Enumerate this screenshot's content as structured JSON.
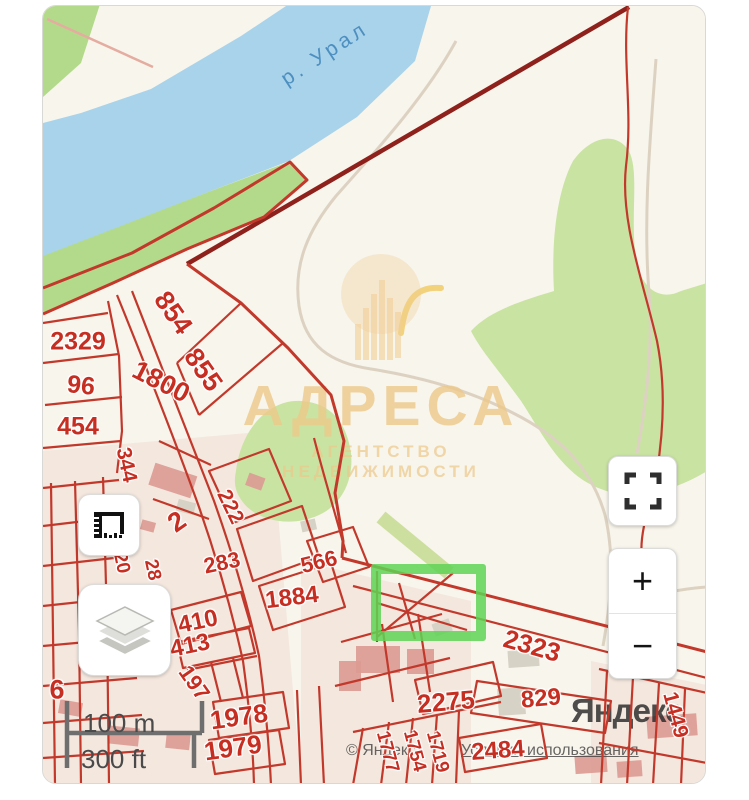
{
  "theme": {
    "land": "#f8f5ec",
    "water": "#a9d3ea",
    "green1": "#b3da8a",
    "green2": "#c9e3a2",
    "red": "#c2392c",
    "darkred": "#8e211b",
    "select": "#5ed355",
    "gold": "#eec888",
    "building": "#dc9a92",
    "graybldg": "#d6d2c6",
    "road": "#ddd2c2"
  },
  "map": {
    "river_label": "р. Урал",
    "parcels": [
      {
        "text": "2329",
        "x": 77,
        "y": 341,
        "rot": 0,
        "size": 25
      },
      {
        "text": "96",
        "x": 80,
        "y": 385,
        "rot": 6,
        "size": 25
      },
      {
        "text": "454",
        "x": 77,
        "y": 426,
        "rot": 0,
        "size": 25
      },
      {
        "text": "854",
        "x": 172,
        "y": 312,
        "rot": 55,
        "size": 27
      },
      {
        "text": "855",
        "x": 202,
        "y": 369,
        "rot": 55,
        "size": 27
      },
      {
        "text": "1800",
        "x": 160,
        "y": 381,
        "rot": 27,
        "size": 27
      },
      {
        "text": "344",
        "x": 125,
        "y": 464,
        "rot": 78,
        "size": 21
      },
      {
        "text": "2",
        "x": 176,
        "y": 521,
        "rot": -35,
        "size": 27
      },
      {
        "text": "222",
        "x": 229,
        "y": 506,
        "rot": 64,
        "size": 21
      },
      {
        "text": "283",
        "x": 221,
        "y": 562,
        "rot": -12,
        "size": 22
      },
      {
        "text": "566",
        "x": 318,
        "y": 561,
        "rot": -14,
        "size": 22
      },
      {
        "text": "1884",
        "x": 291,
        "y": 597,
        "rot": -7,
        "size": 24
      },
      {
        "text": "20",
        "x": 120,
        "y": 562,
        "rot": 78,
        "size": 19
      },
      {
        "text": "28",
        "x": 151,
        "y": 569,
        "rot": 78,
        "size": 19
      },
      {
        "text": "410",
        "x": 197,
        "y": 621,
        "rot": -12,
        "size": 24
      },
      {
        "text": "413",
        "x": 189,
        "y": 645,
        "rot": -12,
        "size": 24
      },
      {
        "text": "197",
        "x": 193,
        "y": 682,
        "rot": 55,
        "size": 22
      },
      {
        "text": "6",
        "x": 56,
        "y": 689,
        "rot": 0,
        "size": 27
      },
      {
        "text": "1978",
        "x": 238,
        "y": 716,
        "rot": -8,
        "size": 26
      },
      {
        "text": "1979",
        "x": 232,
        "y": 747,
        "rot": -8,
        "size": 26
      },
      {
        "text": "1777",
        "x": 386,
        "y": 751,
        "rot": 75,
        "size": 19
      },
      {
        "text": "1754",
        "x": 413,
        "y": 750,
        "rot": 75,
        "size": 19
      },
      {
        "text": "1719",
        "x": 436,
        "y": 751,
        "rot": 75,
        "size": 19
      },
      {
        "text": "2275",
        "x": 445,
        "y": 701,
        "rot": -5,
        "size": 26
      },
      {
        "text": "2484",
        "x": 497,
        "y": 750,
        "rot": -4,
        "size": 24
      },
      {
        "text": "829",
        "x": 540,
        "y": 698,
        "rot": -5,
        "size": 24
      },
      {
        "text": "2323",
        "x": 531,
        "y": 645,
        "rot": 16,
        "size": 26
      },
      {
        "text": "1449",
        "x": 674,
        "y": 714,
        "rot": 75,
        "size": 21
      }
    ]
  },
  "watermark": {
    "title": "АДРЕСА",
    "subtitle": "АГЕНТСТВО НЕДВИЖИМОСТИ",
    "icon": "buildings-icon"
  },
  "controls": {
    "ruler_icon": "ruler-icon",
    "layers_icon": "layers-icon",
    "fullscreen_icon": "fullscreen-icon",
    "zoom_in_label": "+",
    "zoom_out_label": "−"
  },
  "scale": {
    "metric": "100 m",
    "imperial": "300 ft"
  },
  "attribution": {
    "copyright": "© Яндекс",
    "terms_link": "Условия использования",
    "logo": "Яндекс"
  }
}
